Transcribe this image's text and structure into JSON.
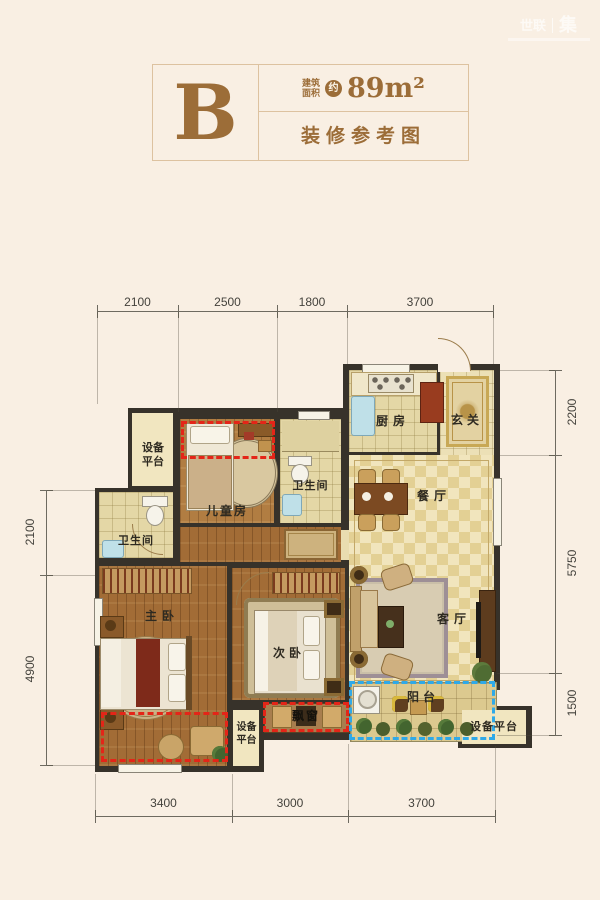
{
  "watermark": {
    "brand": "世联",
    "seal": "集"
  },
  "header": {
    "unit_letter": "B",
    "area_label_line1": "建筑",
    "area_label_line2": "面积",
    "approx_badge": "约",
    "area_value": "89m²",
    "subtitle": "装修参考图"
  },
  "rooms": {
    "equip_platform_top_left": "设备平台",
    "children_room": "儿童房",
    "bathroom_shared": "卫生间",
    "kitchen": "厨房",
    "foyer": "玄关",
    "dining_room": "餐厅",
    "living_room": "客厅",
    "balcony": "阳台",
    "bathroom_master": "卫生间",
    "master_bedroom": "主卧",
    "second_bedroom": "次卧",
    "bay_window": "飘窗",
    "equip_platform_bottom_middle": "设备平台",
    "equip_platform_bottom_right": "设备平台"
  },
  "dimensions": {
    "top": [
      "2100",
      "2500",
      "1800",
      "3700"
    ],
    "bottom": [
      "3400",
      "3000",
      "3700"
    ],
    "left": [
      "2100",
      "4900"
    ],
    "right": [
      "2200",
      "5750",
      "1500"
    ]
  },
  "colors": {
    "accent": "#9c6d38",
    "wall": "#37322a",
    "red_dash": "#e42518",
    "blue_dash": "#2fa9e8"
  }
}
